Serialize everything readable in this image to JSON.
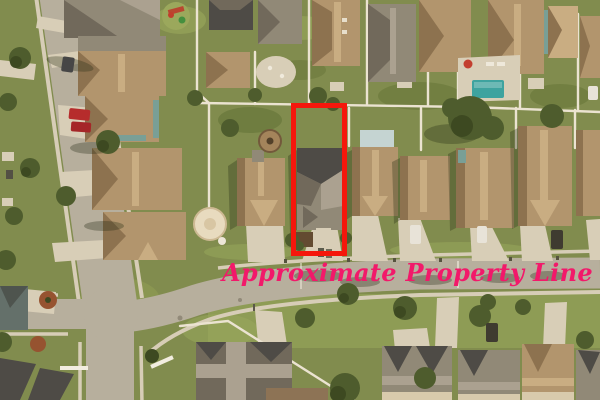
{
  "annotation": {
    "label": "Approximate Property Line",
    "label_color": "#f2196a",
    "outline_color": "#f5170c",
    "outline": {
      "x": 291,
      "y": 103,
      "width": 56,
      "height": 153,
      "stroke_width": 5
    },
    "label_pos": {
      "x": 222,
      "y": 261
    }
  },
  "palette": {
    "grass-base": "#7d8c4e",
    "grass-light": "#98a95d",
    "grass-dark": "#556830",
    "tree": "#47592c",
    "tree-dark": "#35451f",
    "asphalt": "#b6b0a2",
    "sidewalk": "#d7d0bd",
    "concrete": "#d9d1bd",
    "roof-tan": "#b0956f",
    "roof-tan-dark": "#8a7050",
    "roof-tan-light": "#c9ae85",
    "roof-gray": "#8e887a",
    "roof-gray-dark": "#6c675c",
    "roof-gray-light": "#a9a294",
    "roof-dark": "#474746",
    "wall-cream": "#d9cdb2",
    "wall-teal": "#74a09a",
    "patio-blue": "#c5d7da",
    "pool": "#36a4a4",
    "fence": "#ece7d8",
    "mulch": "#93502f",
    "car-red": "#b5262b",
    "car-white": "#e9e7e0",
    "car-dark": "#37362f",
    "umbrella": "#c23a2e"
  }
}
